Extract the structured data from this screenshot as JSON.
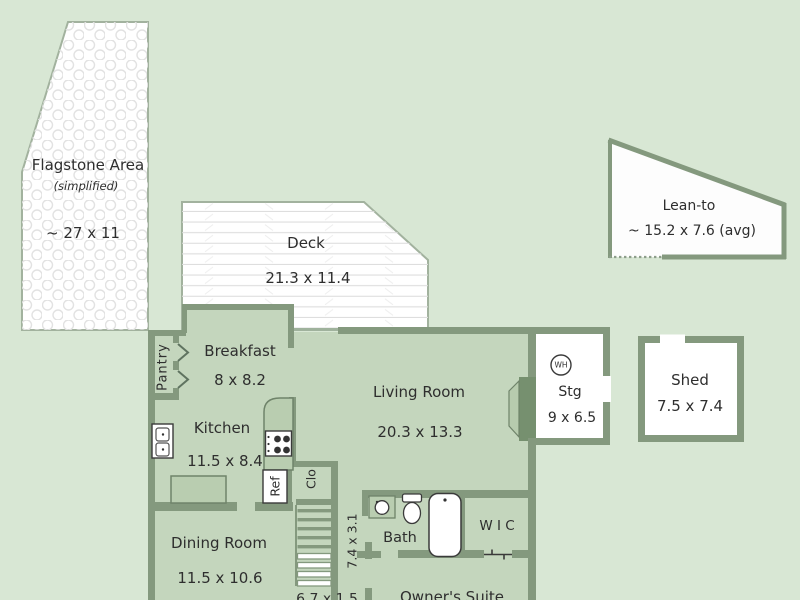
{
  "plan": {
    "rooms": {
      "flagstone": {
        "label": "Flagstone Area",
        "sub": "(simplified)",
        "dim": "~ 27 x 11"
      },
      "deck": {
        "label": "Deck",
        "dim": "21.3 x 11.4"
      },
      "lean_to": {
        "label": "Lean-to",
        "dim": "~ 15.2 x 7.6 (avg)"
      },
      "shed": {
        "label": "Shed",
        "dim": "7.5 x 7.4"
      },
      "breakfast": {
        "label": "Breakfast",
        "dim": "8 x 8.2"
      },
      "pantry": {
        "label": "Pantry"
      },
      "kitchen": {
        "label": "Kitchen",
        "dim": "11.5 x 8.4"
      },
      "living_room": {
        "label": "Living Room",
        "dim": "20.3 x 13.3"
      },
      "storage": {
        "label": "Stg",
        "dim": "9 x 6.5",
        "water_heater": "WH"
      },
      "closet": {
        "label": "Clo"
      },
      "refrigerator": {
        "label": "Ref"
      },
      "dining_room": {
        "label": "Dining Room",
        "dim": "11.5 x 10.6"
      },
      "hall": {
        "dim": "7.4 x 3.1"
      },
      "bath": {
        "label": "Bath"
      },
      "wic": {
        "label": "W I C"
      },
      "owners_suite": {
        "label": "Owner's Suite",
        "partial_dim": "6.7 x 1.5"
      }
    },
    "colors": {
      "background": "#d8e7d4",
      "floor": "#c4d6bd",
      "wall": "#84997e",
      "white_area": "#ffffff",
      "counter": "#b9cdb0",
      "fixture_outline": "#3a3a3a"
    }
  }
}
